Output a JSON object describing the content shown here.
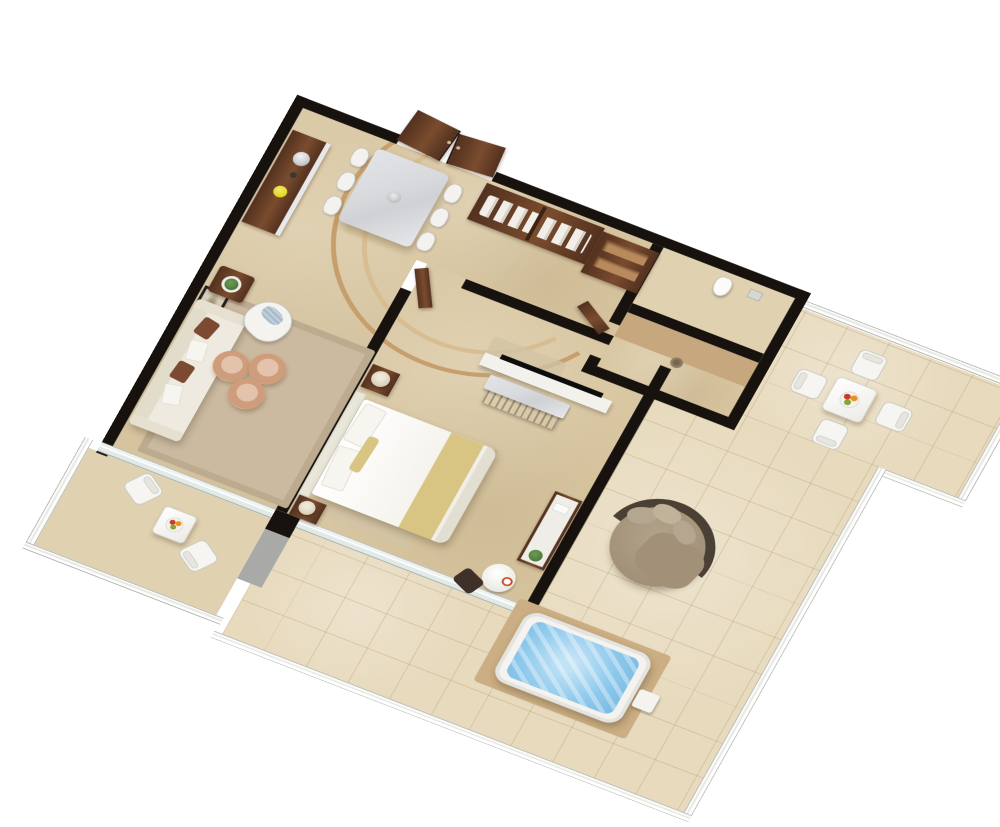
{
  "scene": {
    "kind": "isometric-3d-floorplan-render",
    "subject": "one-bedroom-suite-with-wraparound-terrace",
    "background": "#ffffff",
    "projection": "axonometric"
  },
  "palette": {
    "wall": "#17120e",
    "floor": "#d9c7a2",
    "floor-light": "#e0d2b0",
    "tile": "#e7dabd",
    "tile-line": "rgba(166,144,102,0.30)",
    "platform": "#cbae83",
    "shower": "#c6a77e",
    "wood": "#53311f",
    "wood-light": "#7a4c2e",
    "marble": "#d9dadd",
    "rug": "#cbbaa0",
    "gold": "#d9c583",
    "water": "#8ec9ec",
    "pouf": "#cf9d7b",
    "pouf-swirl": "#e3c3ac",
    "pouf-rim": "#f0e2d2",
    "pillow-brown": "#7b4a30",
    "blue-cushion": "#a9bccb",
    "taupe": "#a29178",
    "daybed-ring": "#4a4034",
    "daybed-pillow": "#b5a78f",
    "lamp": "#d8cdb8",
    "plant": "#4d7a3a",
    "yellow-bowl": "#e3d41f",
    "silver": "#c9cbcd",
    "steps-dark": "#c69f6d",
    "steps-light": "#d9bd92",
    "grey-pillar": "#a9a9a7",
    "tv-black": "#0d0d0d"
  },
  "rooms": {
    "dining": {
      "label": "dining-area",
      "items": [
        "walnut-sideboard",
        "silver-cloche",
        "yellow-bowl",
        "marble-dining-table",
        "table-centerpiece"
      ],
      "dining_chair_count": 6
    },
    "entry": {
      "label": "entry",
      "items": [
        "double-entry-doors"
      ],
      "door_leaf_count": 2
    },
    "dressing": {
      "label": "dressing-corridor",
      "items": [
        "open-wardrobe-with-hanging-clothes",
        "open-shelf-unit",
        "closet-door",
        "bathroom-door"
      ]
    },
    "bathroom": {
      "label": "bathroom",
      "items": [
        "toilet",
        "shower-with-drain"
      ]
    },
    "living": {
      "label": "living-room",
      "items": [
        "wall-artwork",
        "cream-sofa",
        "side-table-with-plant",
        "armchair-blue-cushion",
        "area-rug",
        "curved-steps"
      ],
      "sofa_pillow_count": 4,
      "pouf_count": 3,
      "curved_step_count": 2
    },
    "bedroom": {
      "label": "bedroom",
      "items": [
        "king-bed-gold-runner",
        "headboard",
        "tv-partition-wall",
        "flatscreen-tv",
        "marble-top-bench",
        "console-with-plant",
        "round-desk-with-chair",
        "plate"
      ],
      "nightstand_count": 2,
      "lamp_count": 2,
      "bed_pillow_count": 3
    },
    "terrace": {
      "label": "wraparound-terrace",
      "items": [
        "outdoor-dining-table",
        "fruit-bowl",
        "round-daybed",
        "jacuzzi",
        "jacuzzi-platform",
        "jacuzzi-step",
        "glass-railing"
      ],
      "outdoor_chair_count": 4,
      "daybed_pillow_count": 3
    },
    "balcony": {
      "label": "side-balcony",
      "items": [
        "bistro-table",
        "fruit-bowl",
        "glass-railing"
      ],
      "balcony_chair_count": 2
    }
  }
}
